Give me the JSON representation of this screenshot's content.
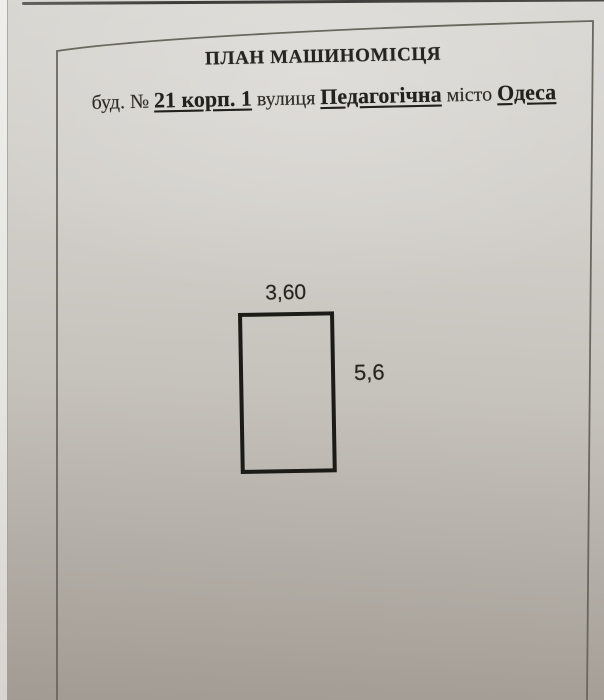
{
  "document": {
    "title": "ПЛАН МАШИНОМІСЦЯ",
    "address": {
      "building_label": "буд. №",
      "building_value": "21 корп. 1",
      "street_label": "вулиця",
      "street_value": "Педагогічна",
      "city_label": "місто",
      "city_value": "Одеса"
    },
    "plan": {
      "width_dimension": "3,60",
      "height_dimension": "5,6"
    }
  },
  "colors": {
    "paper_light": "#d9d7d2",
    "paper_dark": "#a29b93",
    "ink": "#262420",
    "frame_line": "#6a675f",
    "rectangle_border": "#1c1b17"
  }
}
